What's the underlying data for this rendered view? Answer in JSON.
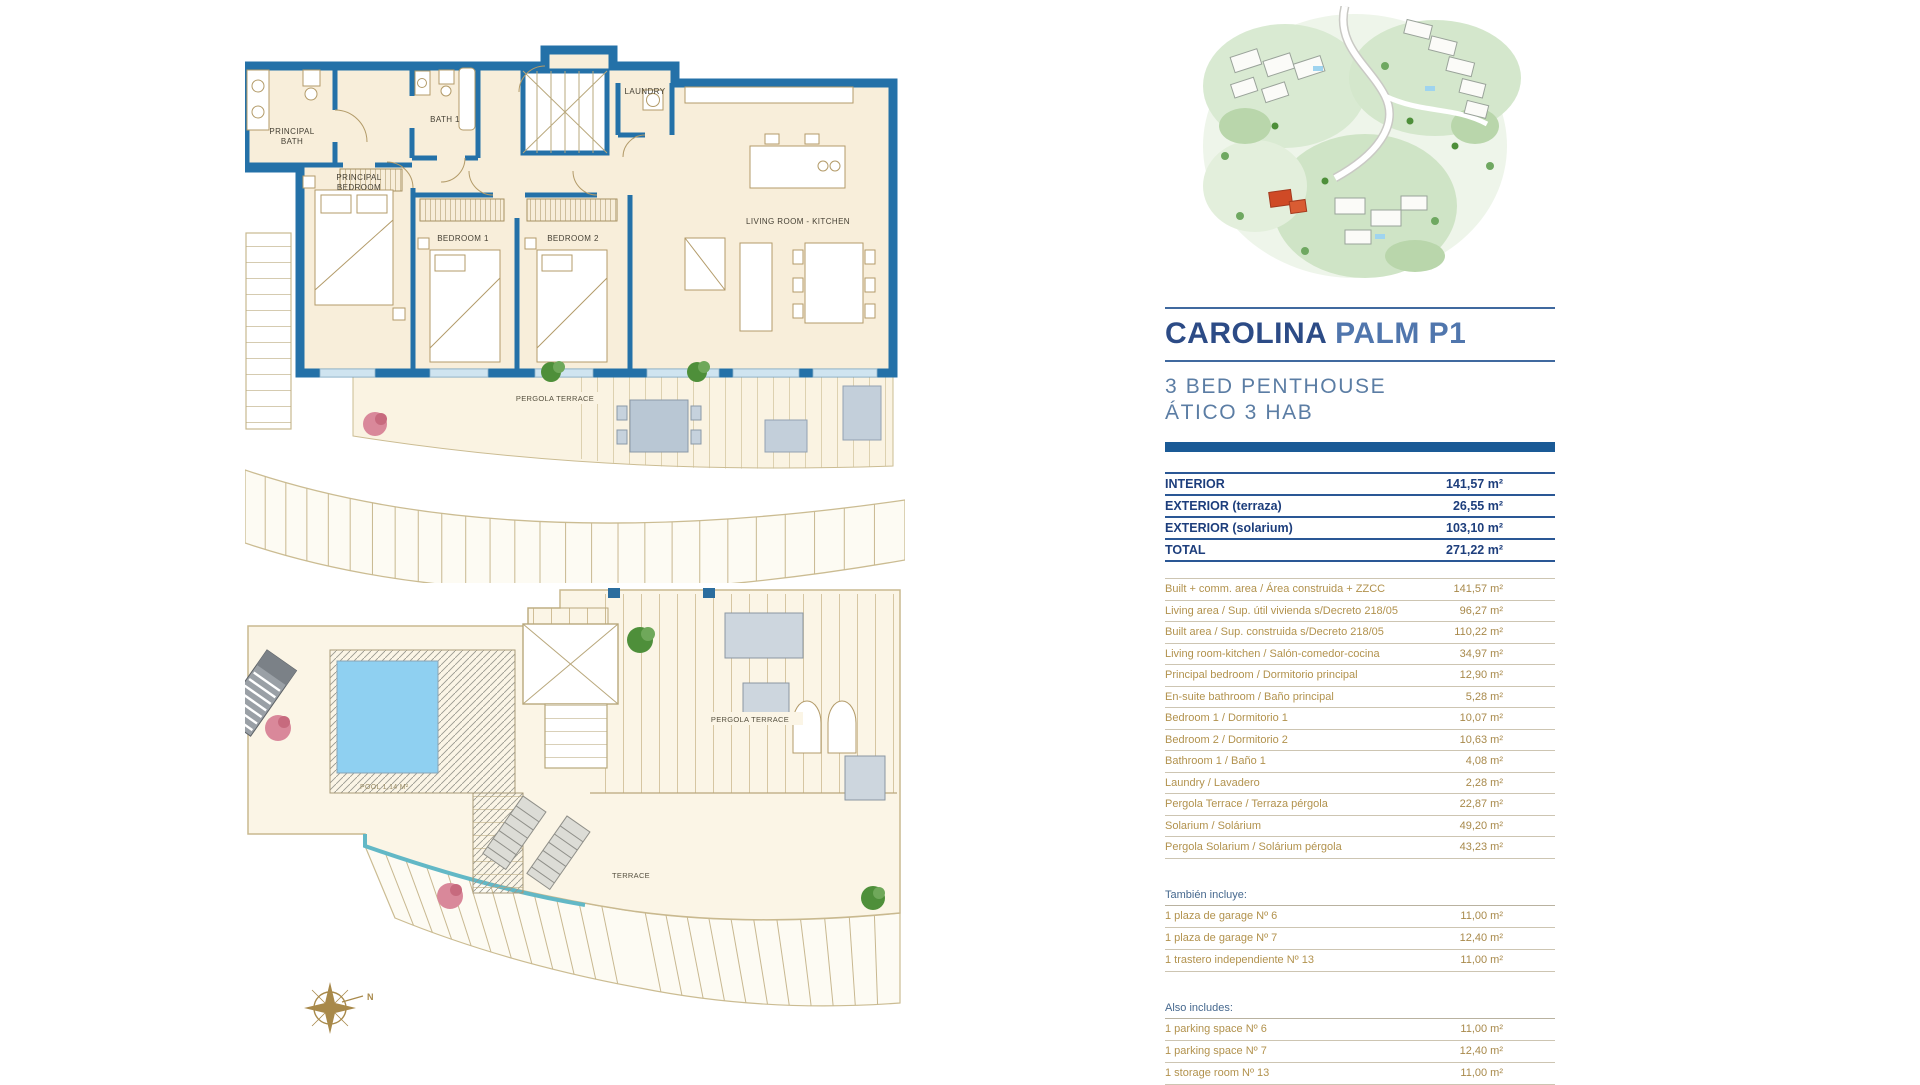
{
  "colors": {
    "wall_blue": "#2471a8",
    "navy": "#1d3e7c",
    "title_blue_dark": "#2c4b86",
    "title_blue_light": "#5076ad",
    "gold": "#b2924d",
    "pool_blue": "#8fd0f1",
    "teal_accent": "#62b8c6",
    "highlight_red": "#cf4a26",
    "room_cream": "#f8eeda"
  },
  "header": {
    "title_primary": "CAROLINA",
    "title_secondary": "PALM P1",
    "subtitle_line1": "3 BED PENTHOUSE",
    "subtitle_line2": "ÁTICO 3 HAB"
  },
  "summary_table": {
    "rows": [
      {
        "label": "INTERIOR",
        "value": "141,57 m²"
      },
      {
        "label": "EXTERIOR (terraza)",
        "value": "26,55 m²"
      },
      {
        "label": "EXTERIOR (solarium)",
        "value": "103,10 m²"
      },
      {
        "label": "TOTAL",
        "value": "271,22 m²"
      }
    ]
  },
  "areas_table": {
    "rows": [
      {
        "label": "Built + comm. area / Área construida + ZZCC",
        "value": "141,57 m²"
      },
      {
        "label": "Living area / Sup. útil vivienda s/Decreto 218/05",
        "value": "96,27 m²"
      },
      {
        "label": "Built area / Sup. construida s/Decreto 218/05",
        "value": "110,22 m²"
      },
      {
        "label": "Living room-kitchen / Salón-comedor-cocina",
        "value": "34,97 m²"
      },
      {
        "label": "Principal bedroom / Dormitorio principal",
        "value": "12,90 m²"
      },
      {
        "label": "En-suite bathroom / Baño principal",
        "value": "5,28 m²"
      },
      {
        "label": "Bedroom 1 / Dormitorio 1",
        "value": "10,07 m²"
      },
      {
        "label": "Bedroom 2 / Dormitorio 2",
        "value": "10,63 m²"
      },
      {
        "label": "Bathroom 1 / Baño 1",
        "value": "4,08 m²"
      },
      {
        "label": "Laundry / Lavadero",
        "value": "2,28 m²"
      },
      {
        "label": "Pergola Terrace / Terraza pérgola",
        "value": "22,87 m²"
      },
      {
        "label": "Solarium / Solárium",
        "value": "49,20 m²"
      },
      {
        "label": "Pergola Solarium / Solárium pérgola",
        "value": "43,23 m²"
      }
    ]
  },
  "includes_es": {
    "heading": "También incluye:",
    "rows": [
      {
        "label": "1 plaza de garage Nº 6",
        "value": "11,00 m²"
      },
      {
        "label": "1 plaza de garage Nº 7",
        "value": "12,40 m²"
      },
      {
        "label": "1 trastero independiente Nº 13",
        "value": "11,00 m²"
      }
    ]
  },
  "includes_en": {
    "heading": "Also includes:",
    "rows": [
      {
        "label": "1 parking space Nº 6",
        "value": "11,00 m²"
      },
      {
        "label": "1 parking space Nº 7",
        "value": "12,40 m²"
      },
      {
        "label": "1 storage room Nº 13",
        "value": "11,00 m²"
      }
    ]
  },
  "plans": {
    "upper": {
      "labels": {
        "principal_bath_l1": "PRINCIPAL",
        "principal_bath_l2": "BATH",
        "principal_bedroom_l1": "PRINCIPAL",
        "principal_bedroom_l2": "BEDROOM",
        "bath_1": "BATH 1",
        "laundry": "LAUNDRY",
        "bedroom_1": "BEDROOM 1",
        "bedroom_2": "BEDROOM 2",
        "living_room": "LIVING ROOM - KITCHEN",
        "pergola_terrace": "PERGOLA TERRACE"
      }
    },
    "lower": {
      "labels": {
        "pool": "POOL 1,14 M²",
        "pergola_terrace": "PERGOLA TERRACE",
        "terrace": "TERRACE",
        "north": "N"
      }
    }
  }
}
